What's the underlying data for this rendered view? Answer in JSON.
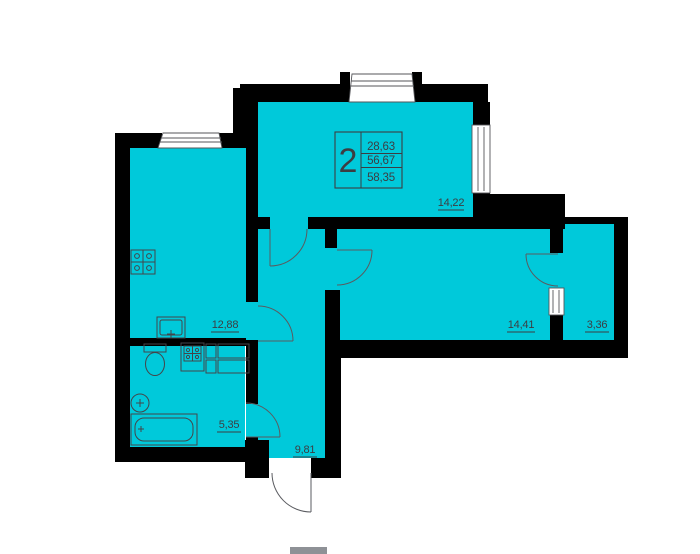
{
  "plan": {
    "title": "2-room apartment floor plan",
    "info_box": {
      "rooms_count": "2",
      "area_living": "28,63",
      "area_total": "56,67",
      "area_overall": "58,35"
    },
    "rooms": [
      {
        "name": "living-room",
        "area": "14,22"
      },
      {
        "name": "kitchen-living",
        "area": "12,88"
      },
      {
        "name": "bedroom",
        "area": "14,41"
      },
      {
        "name": "balcony",
        "area": "3,36"
      },
      {
        "name": "bathroom",
        "area": "5,35"
      },
      {
        "name": "hallway",
        "area": "9,81"
      }
    ],
    "colors": {
      "floor": "#00c9da",
      "walls": "#000000",
      "lines": "#55565a",
      "labels": "#3c3d42"
    },
    "icons": [
      "stove-icon",
      "kitchen-sink-icon",
      "toilet-icon",
      "washing-machine-icon",
      "cabinet-icon",
      "wash-basin-icon",
      "bathtub-icon",
      "door-arc-icon",
      "window-icon"
    ]
  }
}
